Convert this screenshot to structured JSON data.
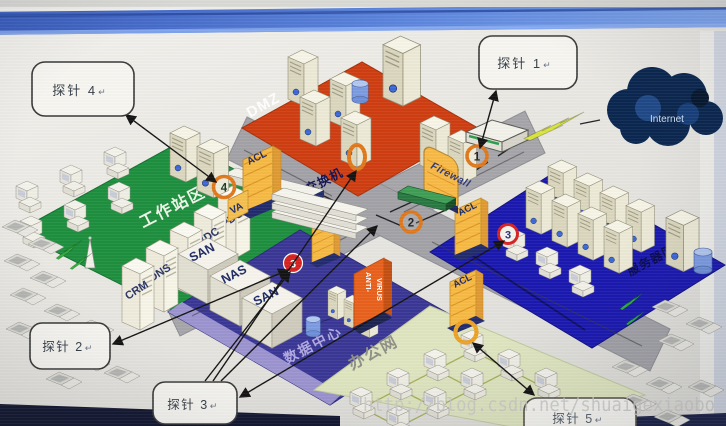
{
  "callouts": {
    "probe1": "探针 1",
    "probe2": "探针 2",
    "probe3": "探针 3",
    "probe4": "探针 4",
    "probe5": "探针 5",
    "return_mark": "↵"
  },
  "zones": {
    "dmz": "DMZ",
    "workstation": "工作站区",
    "datacenter": "数据中心",
    "office": "办公网",
    "server_zone": "服务器区"
  },
  "nodes": {
    "internet": "Internet",
    "firewall": "Firewall",
    "core_switch": "核心交换机",
    "antivirus_top": "ANTI-",
    "antivirus_bottom": "VIRUS",
    "acl": "ACL",
    "va": "VA"
  },
  "rack_servers": [
    "CRM",
    "DNS",
    "EMAIL",
    "BDC",
    "PDC"
  ],
  "storage": [
    "SAN",
    "NAS",
    "SAN"
  ],
  "markers": {
    "m1": "1",
    "m2": "2",
    "m3": "3",
    "m4": "4"
  },
  "watermark": "http://blog.csdn.net/shuaigexiaobo",
  "colors": {
    "dmz": "#cf3e12",
    "workstation": "#1e8f3e",
    "datacenter": "#3b3896",
    "office": "#dfe6c0",
    "server_zone": "#1b19b0",
    "accent_orange": "#e0791c",
    "marker_red": "#d62222",
    "cloud_navy": "#0b2750",
    "titlebar_blue": "#5c85dc"
  }
}
